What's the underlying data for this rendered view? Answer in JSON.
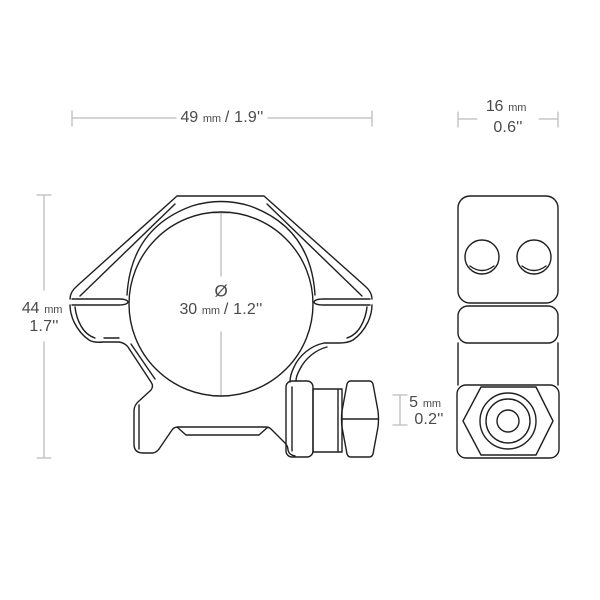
{
  "dimensions": {
    "ring_width": {
      "value": "49",
      "unit": "mm",
      "inches": "/ 1.9''"
    },
    "base_width": {
      "value": "16",
      "unit": "mm",
      "inches": "0.6''"
    },
    "ring_height": {
      "value": "44",
      "unit": "mm",
      "inches": "1.7''"
    },
    "rail_height": {
      "value": "5",
      "unit": "mm",
      "inches": "0.2''"
    },
    "bore_diameter": {
      "symbol": "Ø",
      "value": "30",
      "unit": "mm",
      "inches": "/ 1.2''"
    }
  },
  "colors": {
    "outline": "#1f1f1f",
    "dimension_line": "#bcbcbc",
    "label_text": "#4a4a4a",
    "background": "#ffffff"
  }
}
